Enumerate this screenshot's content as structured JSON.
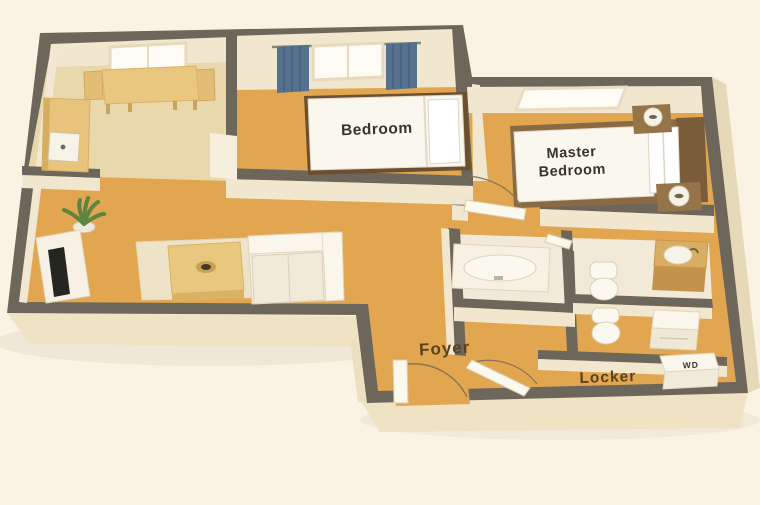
{
  "scene": {
    "background_color": "#faf3e3",
    "wall_color": "#6d665b",
    "wall_face_color": "#f1e7cf",
    "floor_wood_color": "#e1a64f",
    "floor_kitchen_color": "#ead8ad",
    "floor_bath_color": "#f2e9d8",
    "curtain_color": "#56718f",
    "label_dark_color": "#3a332a",
    "label_brown_color": "#57441d"
  },
  "labels": {
    "bedroom": "Bedroom",
    "master_line1": "Master",
    "master_line2": "Bedroom",
    "foyer": "Foyer",
    "locker": "Locker",
    "washer_dryer": "WD"
  }
}
